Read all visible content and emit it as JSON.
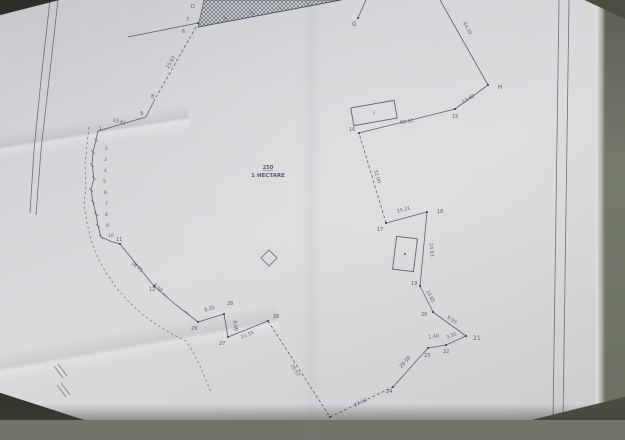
{
  "document_type": "photographed cadastral survey plan",
  "photo": {
    "paper_color": "#d6d7da",
    "backdrop_color": "#70746a",
    "ink_color": "#474c58"
  },
  "plan": {
    "area_label": {
      "plot_number": "250",
      "area_text": "1 HECTARE",
      "x": 268,
      "y": 169
    },
    "hatch_polygon": [
      [
        204,
        0
      ],
      [
        341,
        0
      ],
      [
        198,
        27
      ]
    ],
    "roads": [
      {
        "name": "west-road-outer",
        "points": [
          [
            50,
            0
          ],
          [
            41,
            80
          ],
          [
            34,
            150
          ],
          [
            30,
            213
          ]
        ]
      },
      {
        "name": "west-road-inner",
        "points": [
          [
            58,
            0
          ],
          [
            49,
            80
          ],
          [
            41,
            150
          ],
          [
            36,
            215
          ]
        ]
      },
      {
        "name": "east-road-outer",
        "points": [
          [
            559,
            0
          ],
          [
            553,
            420
          ]
        ]
      },
      {
        "name": "east-road-inner",
        "points": [
          [
            569,
            0
          ],
          [
            563,
            420
          ]
        ]
      }
    ],
    "west_dashed_boundary": [
      [
        89,
        127
      ],
      [
        87,
        145
      ],
      [
        85,
        165
      ],
      [
        86,
        185
      ],
      [
        84,
        205
      ],
      [
        87,
        223
      ],
      [
        91,
        240
      ],
      [
        97,
        256
      ],
      [
        105,
        271
      ],
      [
        115,
        286
      ],
      [
        128,
        301
      ],
      [
        142,
        314
      ],
      [
        157,
        325
      ],
      [
        172,
        334
      ],
      [
        186,
        341
      ],
      [
        193,
        352
      ],
      [
        200,
        366
      ],
      [
        206,
        380
      ],
      [
        211,
        392
      ]
    ],
    "boundary_segments": [
      {
        "dashed": false,
        "points": [
          [
            128,
            37
          ],
          [
            198,
            23
          ]
        ]
      },
      {
        "dashed": false,
        "points": [
          [
            198,
            27
          ],
          [
            341,
            0
          ]
        ]
      },
      {
        "dashed": true,
        "points": [
          [
            196,
            27
          ],
          [
            155,
            99
          ]
        ]
      },
      {
        "dashed": false,
        "points": [
          [
            155,
            99
          ],
          [
            146,
            117
          ]
        ]
      },
      {
        "dashed": false,
        "points": [
          [
            146,
            117
          ],
          [
            98,
            131
          ]
        ]
      },
      {
        "dashed": false,
        "points": [
          [
            98,
            131
          ],
          [
            96,
            140
          ],
          [
            93,
            152
          ],
          [
            92,
            165
          ],
          [
            94,
            178
          ],
          [
            91,
            190
          ],
          [
            93,
            202
          ],
          [
            96,
            214
          ],
          [
            98,
            226
          ],
          [
            101,
            237
          ],
          [
            110,
            241
          ],
          [
            120,
            244
          ]
        ]
      },
      {
        "dashed": false,
        "points": [
          [
            120,
            244
          ],
          [
            154,
            286
          ],
          [
            176,
            305
          ],
          [
            198,
            322
          ]
        ]
      },
      {
        "dashed": false,
        "points": [
          [
            198,
            322
          ],
          [
            224,
            314
          ]
        ]
      },
      {
        "dashed": false,
        "points": [
          [
            224,
            314
          ],
          [
            228,
            337
          ]
        ]
      },
      {
        "dashed": false,
        "points": [
          [
            228,
            337
          ],
          [
            268,
            321
          ]
        ]
      },
      {
        "dashed": true,
        "points": [
          [
            268,
            321
          ],
          [
            330,
            417
          ]
        ]
      },
      {
        "dashed": true,
        "points": [
          [
            330,
            417
          ],
          [
            393,
            387
          ]
        ]
      },
      {
        "dashed": false,
        "points": [
          [
            393,
            387
          ],
          [
            428,
            348
          ]
        ]
      },
      {
        "dashed": false,
        "points": [
          [
            428,
            348
          ],
          [
            446,
            345
          ]
        ]
      },
      {
        "dashed": false,
        "points": [
          [
            446,
            345
          ],
          [
            466,
            336
          ]
        ]
      },
      {
        "dashed": false,
        "points": [
          [
            466,
            336
          ],
          [
            433,
            312
          ]
        ]
      },
      {
        "dashed": false,
        "points": [
          [
            433,
            312
          ],
          [
            420,
            286
          ]
        ]
      },
      {
        "dashed": false,
        "points": [
          [
            420,
            286
          ],
          [
            427,
            212
          ]
        ]
      },
      {
        "dashed": false,
        "points": [
          [
            427,
            212
          ],
          [
            386,
            223
          ]
        ]
      },
      {
        "dashed": true,
        "points": [
          [
            386,
            223
          ],
          [
            359,
            133
          ]
        ]
      },
      {
        "dashed": false,
        "points": [
          [
            359,
            133
          ],
          [
            455,
            109
          ]
        ]
      },
      {
        "dashed": false,
        "points": [
          [
            455,
            109
          ],
          [
            488,
            85
          ]
        ]
      },
      {
        "dashed": false,
        "points": [
          [
            488,
            85
          ],
          [
            440,
            0
          ]
        ]
      },
      {
        "dashed": false,
        "points": [
          [
            358,
            18
          ],
          [
            366,
            0
          ]
        ]
      }
    ],
    "extra_marks": [
      {
        "points": [
          [
            54,
            366
          ],
          [
            63,
            378
          ]
        ]
      },
      {
        "points": [
          [
            58,
            364
          ],
          [
            67,
            376
          ]
        ]
      },
      {
        "points": [
          [
            57,
            385
          ],
          [
            66,
            397
          ]
        ]
      },
      {
        "points": [
          [
            61,
            383
          ],
          [
            70,
            395
          ]
        ]
      }
    ],
    "vertex_dots": [
      [
        358,
        18
      ],
      [
        488,
        85
      ],
      [
        455,
        109
      ],
      [
        359,
        133
      ],
      [
        386,
        223
      ],
      [
        427,
        212
      ],
      [
        420,
        286
      ],
      [
        433,
        312
      ],
      [
        466,
        336
      ],
      [
        446,
        345
      ],
      [
        428,
        348
      ],
      [
        393,
        387
      ],
      [
        330,
        417
      ],
      [
        268,
        321
      ],
      [
        228,
        337
      ],
      [
        224,
        314
      ],
      [
        198,
        322
      ],
      [
        120,
        244
      ],
      [
        154,
        286
      ],
      [
        198,
        23
      ]
    ],
    "tick_points": [
      [
        96,
        140
      ],
      [
        93,
        152
      ],
      [
        92,
        165
      ],
      [
        94,
        178
      ],
      [
        91,
        190
      ],
      [
        93,
        202
      ],
      [
        96,
        214
      ],
      [
        98,
        226
      ],
      [
        101,
        237
      ],
      [
        137,
        265
      ],
      [
        165,
        295
      ],
      [
        187,
        313
      ],
      [
        225,
        18
      ],
      [
        252,
        13
      ],
      [
        280,
        8
      ],
      [
        308,
        4
      ]
    ],
    "point_labels": [
      {
        "text": "D",
        "x": 191,
        "y": 8,
        "size": 5
      },
      {
        "text": "7",
        "x": 186,
        "y": 21,
        "size": 5
      },
      {
        "text": "6",
        "x": 182,
        "y": 33,
        "size": 5
      },
      {
        "text": "8",
        "x": 151,
        "y": 98,
        "size": 5
      },
      {
        "text": "9",
        "x": 140,
        "y": 115,
        "size": 5
      },
      {
        "text": "G",
        "x": 352,
        "y": 26,
        "size": 6
      },
      {
        "text": "H",
        "x": 498,
        "y": 89,
        "size": 6
      },
      {
        "text": "15",
        "x": 452,
        "y": 118,
        "size": 5
      },
      {
        "text": "16",
        "x": 349,
        "y": 131,
        "size": 5
      },
      {
        "text": "17",
        "x": 377,
        "y": 231,
        "size": 5
      },
      {
        "text": "18",
        "x": 437,
        "y": 213,
        "size": 5
      },
      {
        "text": "19",
        "x": 411,
        "y": 285,
        "size": 5
      },
      {
        "text": "20",
        "x": 421,
        "y": 316,
        "size": 5
      },
      {
        "text": "21",
        "x": 473,
        "y": 340,
        "size": 6
      },
      {
        "text": "22",
        "x": 443,
        "y": 353,
        "size": 5
      },
      {
        "text": "23",
        "x": 424,
        "y": 357,
        "size": 5
      },
      {
        "text": "24",
        "x": 386,
        "y": 393,
        "size": 5
      },
      {
        "text": "26",
        "x": 273,
        "y": 318,
        "size": 5
      },
      {
        "text": "27",
        "x": 219,
        "y": 345,
        "size": 5
      },
      {
        "text": "28",
        "x": 227,
        "y": 305,
        "size": 5
      },
      {
        "text": "29",
        "x": 191,
        "y": 330,
        "size": 5
      },
      {
        "text": "11",
        "x": 116,
        "y": 241,
        "size": 5
      },
      {
        "text": "12",
        "x": 149,
        "y": 291,
        "size": 5
      },
      {
        "text": "1",
        "x": 99,
        "y": 130,
        "size": 4.5
      },
      {
        "text": "2",
        "x": 105,
        "y": 150,
        "size": 4.5
      },
      {
        "text": "3",
        "x": 104,
        "y": 161,
        "size": 4.5
      },
      {
        "text": "4",
        "x": 104,
        "y": 172,
        "size": 4.5
      },
      {
        "text": "5",
        "x": 103,
        "y": 183,
        "size": 4.5
      },
      {
        "text": "6",
        "x": 104,
        "y": 194,
        "size": 4.5
      },
      {
        "text": "7",
        "x": 105,
        "y": 205,
        "size": 4.5
      },
      {
        "text": "8",
        "x": 105,
        "y": 216,
        "size": 4.5
      },
      {
        "text": "9",
        "x": 106,
        "y": 227,
        "size": 4.5
      },
      {
        "text": "10",
        "x": 108,
        "y": 237,
        "size": 4.5
      }
    ],
    "measurements": [
      {
        "text": "25.93",
        "x": 172,
        "y": 63,
        "rot": -60
      },
      {
        "text": "15.61",
        "x": 119,
        "y": 123,
        "rot": 16
      },
      {
        "text": "16.75",
        "x": 136,
        "y": 268,
        "rot": 40
      },
      {
        "text": "8.58",
        "x": 157,
        "y": 289,
        "rot": 40
      },
      {
        "text": "8.25",
        "x": 210,
        "y": 310,
        "rot": -17
      },
      {
        "text": "9.06",
        "x": 234,
        "y": 326,
        "rot": 80
      },
      {
        "text": "11.55",
        "x": 248,
        "y": 336,
        "rot": -22
      },
      {
        "text": "28.57",
        "x": 294,
        "y": 371,
        "rot": 57
      },
      {
        "text": "27.58",
        "x": 361,
        "y": 404,
        "rot": -25
      },
      {
        "text": "28.58",
        "x": 406,
        "y": 363,
        "rot": -48
      },
      {
        "text": "1.40",
        "x": 434,
        "y": 338,
        "rot": -10
      },
      {
        "text": "3.35",
        "x": 452,
        "y": 337,
        "rot": -20
      },
      {
        "text": "9.50",
        "x": 451,
        "y": 321,
        "rot": 36
      },
      {
        "text": "10.85",
        "x": 429,
        "y": 297,
        "rot": 63
      },
      {
        "text": "24.93",
        "x": 430,
        "y": 250,
        "rot": 85
      },
      {
        "text": "15.21",
        "x": 404,
        "y": 211,
        "rot": -15
      },
      {
        "text": "32.00",
        "x": 376,
        "y": 177,
        "rot": 73
      },
      {
        "text": "58.52",
        "x": 407,
        "y": 123,
        "rot": -9
      },
      {
        "text": "13.60",
        "x": 469,
        "y": 100,
        "rot": -30
      },
      {
        "text": "44.20",
        "x": 466,
        "y": 29,
        "rot": 60
      }
    ],
    "buildings": [
      {
        "name": "building-I",
        "cx": 374,
        "cy": 113,
        "w": 44,
        "h": 18,
        "rot": -10,
        "label": "I"
      },
      {
        "name": "building-2",
        "cx": 405,
        "cy": 254,
        "w": 21,
        "h": 33,
        "rot": 7,
        "label": ""
      }
    ],
    "diamond": {
      "cx": 269,
      "cy": 258,
      "r": 8
    }
  }
}
